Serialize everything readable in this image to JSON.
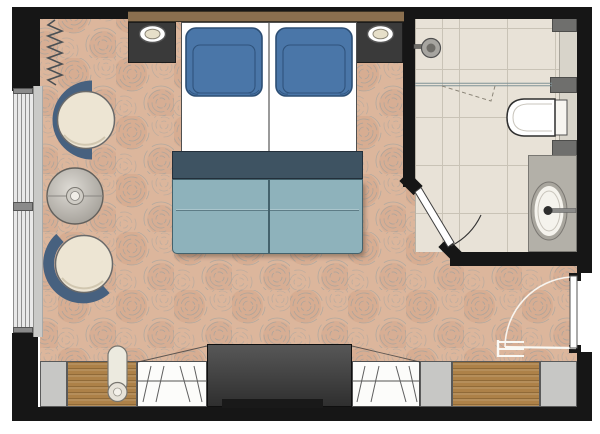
{
  "plan": {
    "type": "hotel-guestroom-floor-plan",
    "bedroom": {
      "items": [
        "double-bed",
        "pillow-left",
        "pillow-right",
        "bed-throw",
        "bed-blanket",
        "nightstand-left",
        "nightstand-right",
        "table-lamp-left",
        "table-lamp-right",
        "lounge-chair-upper",
        "lounge-chair-lower",
        "round-side-table",
        "window",
        "curtain",
        "wardrobe-left",
        "wardrobe-right",
        "media-unit",
        "luggage-bench",
        "bolster-cushion"
      ]
    },
    "bathroom": {
      "items": [
        "shower-head",
        "glass-screen",
        "toilet",
        "washbasin",
        "vanity-counter",
        "faucet",
        "bathroom-door",
        "door-swing-arc",
        "wall-niche-blocks"
      ]
    },
    "entry": {
      "items": [
        "entrance-door",
        "door-swing-arc",
        "folding-luggage-rack"
      ]
    }
  },
  "colors": {
    "wall": "#161616",
    "carpet-base": "#dcb69c",
    "carpet-shade": "#cfa183",
    "carpet-scribble": "#7d98a2",
    "tile": "#e8e2d7",
    "tile-line": "#c9c3b6",
    "wood-trim": "#8a6f4f",
    "nightstand": "#3a3a3a",
    "mattress": "#ffffff",
    "pillow": "#4a76a8",
    "pillow-edge": "#2c4e74",
    "throw": "#3e5362",
    "throw-edge": "#232f3a",
    "blanket": "#8eb2bb",
    "blanket-edge": "#44626c",
    "blanket-fold": "#aac5cc",
    "chair-back": "#47617f",
    "chair-seat": "#ede5d3",
    "seat-edge": "#6a6a6a",
    "metal-light": "#dedbd5",
    "metal-dark": "#a19d96",
    "window-line": "#8f8f8f",
    "window-glass": "#e8e8e8",
    "sill": "#c9c9c7",
    "furn-gray": "#c7c7c5",
    "closet": "#fcfcfa",
    "closet-line": "#5f5f5f",
    "wood-unit": "#ad8148",
    "tv-top": "#575757",
    "tv-bottom": "#2f2f2f",
    "tv-base": "#191919",
    "fixture": "#b3b0a8",
    "fixture-dark": "#6f6f6d",
    "ledge": "#d8d4ca",
    "glass-line": "#7f9296",
    "white-line": "#faf9f4",
    "outline": "#4a4a4a"
  }
}
